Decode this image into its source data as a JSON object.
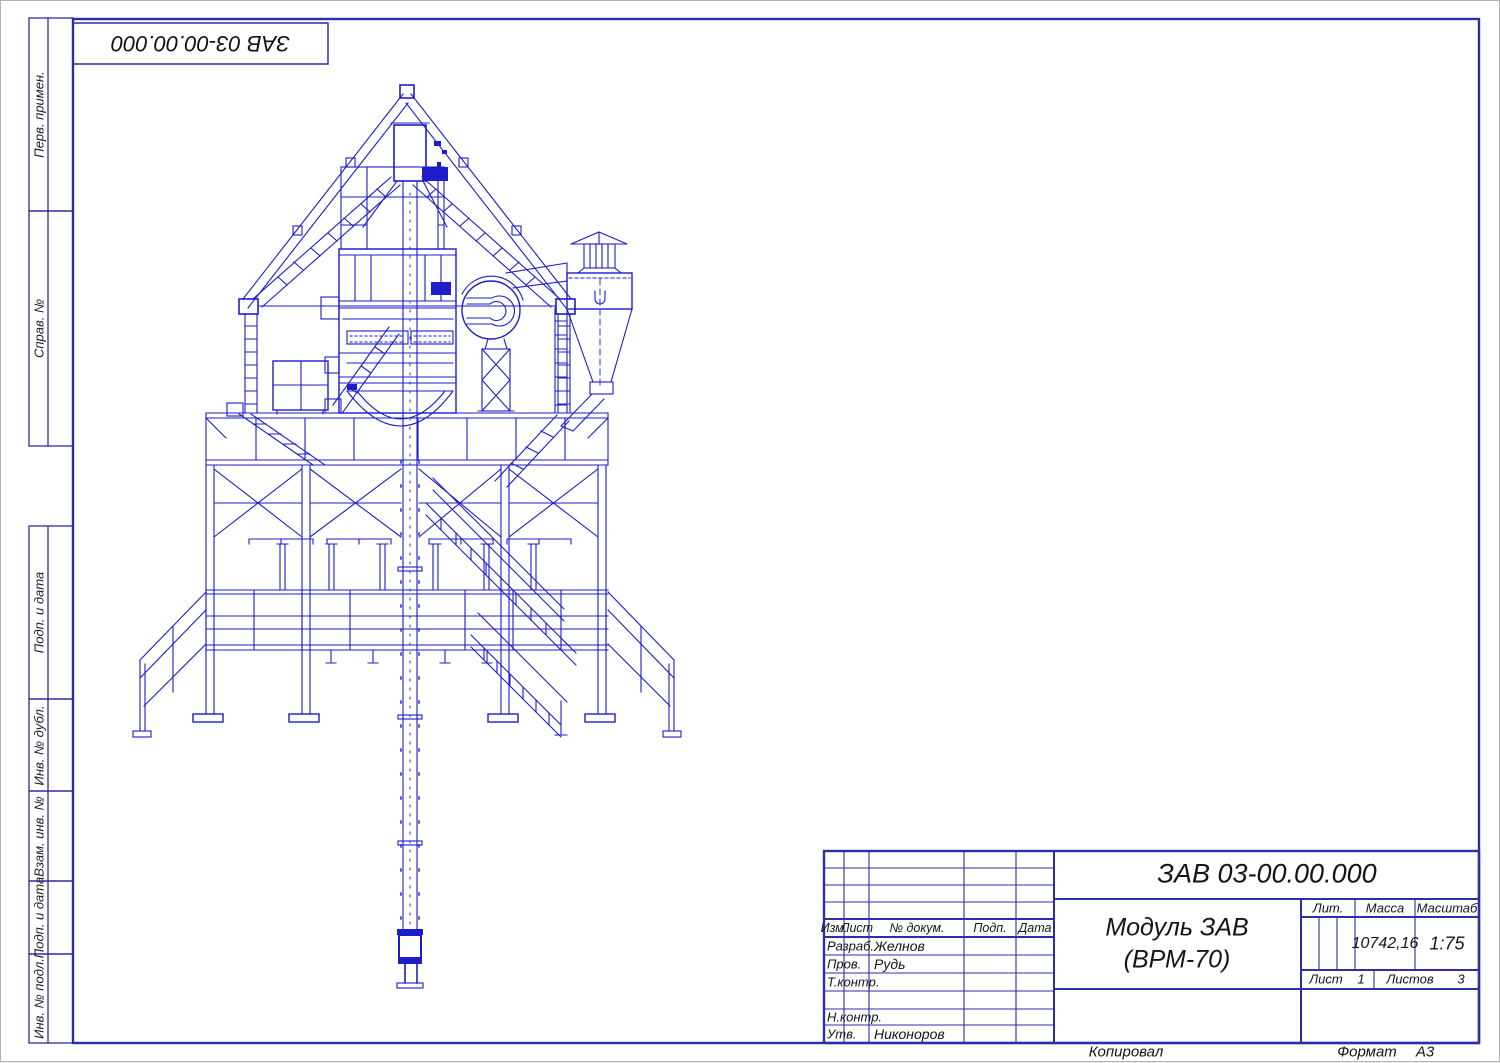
{
  "colors": {
    "drawing_line": "#1d1dc9",
    "frame_line": "#2d2da6",
    "text": "#151515"
  },
  "stamp_top": {
    "designation": "ЗАВ 03-00.00.000"
  },
  "margin_labels": {
    "perv": "Перв. примен.",
    "sprav": "Справ. №",
    "podp1": "Подп. и дата",
    "inv_dubl": "Инв. № дубл.",
    "vzam": "Взам. инв. №",
    "podp2": "Подп. и дата",
    "inv_podl": "Инв. № подл."
  },
  "title_block": {
    "designation": "ЗАВ 03-00.00.000",
    "doc_name_line1": "Модуль ЗАВ",
    "doc_name_line2": "(ВРМ-70)",
    "col_izm": "Изм.",
    "col_list": "Лист",
    "col_dokum": "№ докум.",
    "col_podp": "Подп.",
    "col_data": "Дата",
    "row_razrab": "Разраб.",
    "name_razrab": "Желнов",
    "row_prov": "Пров.",
    "name_prov": "Рудь",
    "row_tkontr": "Т.контр.",
    "row_nkontr": "Н.контр.",
    "row_utv": "Утв.",
    "name_utv": "Никоноров",
    "lit_label": "Лит.",
    "mass_label": "Масса",
    "scale_label": "Масштаб",
    "mass_value": "10742,16",
    "scale_value": "1:75",
    "sheet_label": "Лист",
    "sheet_value": "1",
    "sheets_label": "Листов",
    "sheets_value": "3"
  },
  "footer": {
    "copied": "Копировал",
    "format_label": "Формат",
    "format_value": "А3"
  }
}
